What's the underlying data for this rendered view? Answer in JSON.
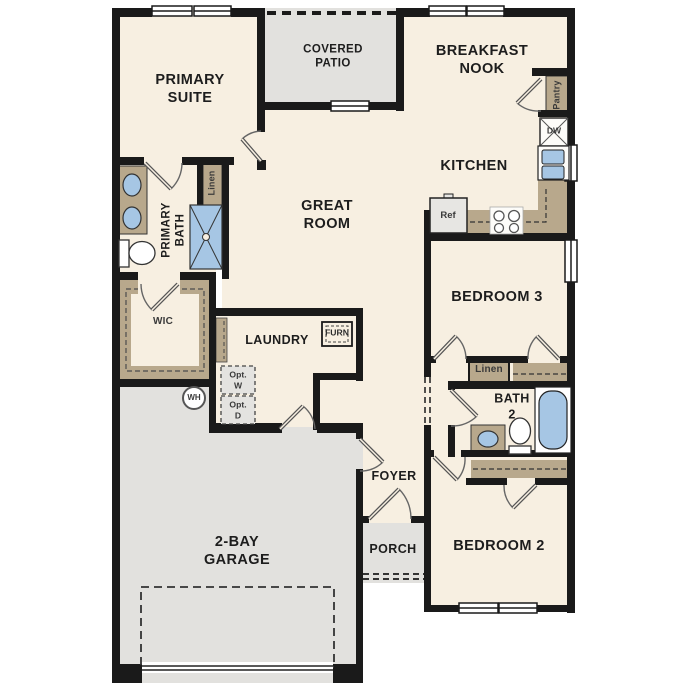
{
  "title": "Single-story residential floor plan",
  "colors": {
    "wall": "#1a1a1a",
    "room_cream": "#f7efe1",
    "concrete_gray": "#e2e1de",
    "cabinet_tan": "#b8a88c",
    "fixture_blue": "#a6c6e4",
    "appliance_gray": "#e7e6e3"
  },
  "labels": {
    "primary_suite": "PRIMARY\nSUITE",
    "covered_patio": "COVERED\nPATIO",
    "breakfast_nook": "BREAKFAST\nNOOK",
    "kitchen": "KITCHEN",
    "great_room": "GREAT\nROOM",
    "primary_bath": "PRIMARY\nBATH",
    "linen_primary": "Linen",
    "pantry": "Pantry",
    "dishwasher": "DW",
    "refrigerator": "Ref",
    "wic": "WIC",
    "laundry": "LAUNDRY",
    "furnace": "FURN",
    "opt_washer": "Opt.\nW",
    "opt_dryer": "Opt.\nD",
    "water_heater": "WH",
    "bedroom3": "BEDROOM 3",
    "linen_hall": "Linen",
    "bath2": "BATH\n2",
    "bedroom2": "BEDROOM 2",
    "foyer": "FOYER",
    "porch": "PORCH",
    "garage": "2-BAY\nGARAGE"
  }
}
